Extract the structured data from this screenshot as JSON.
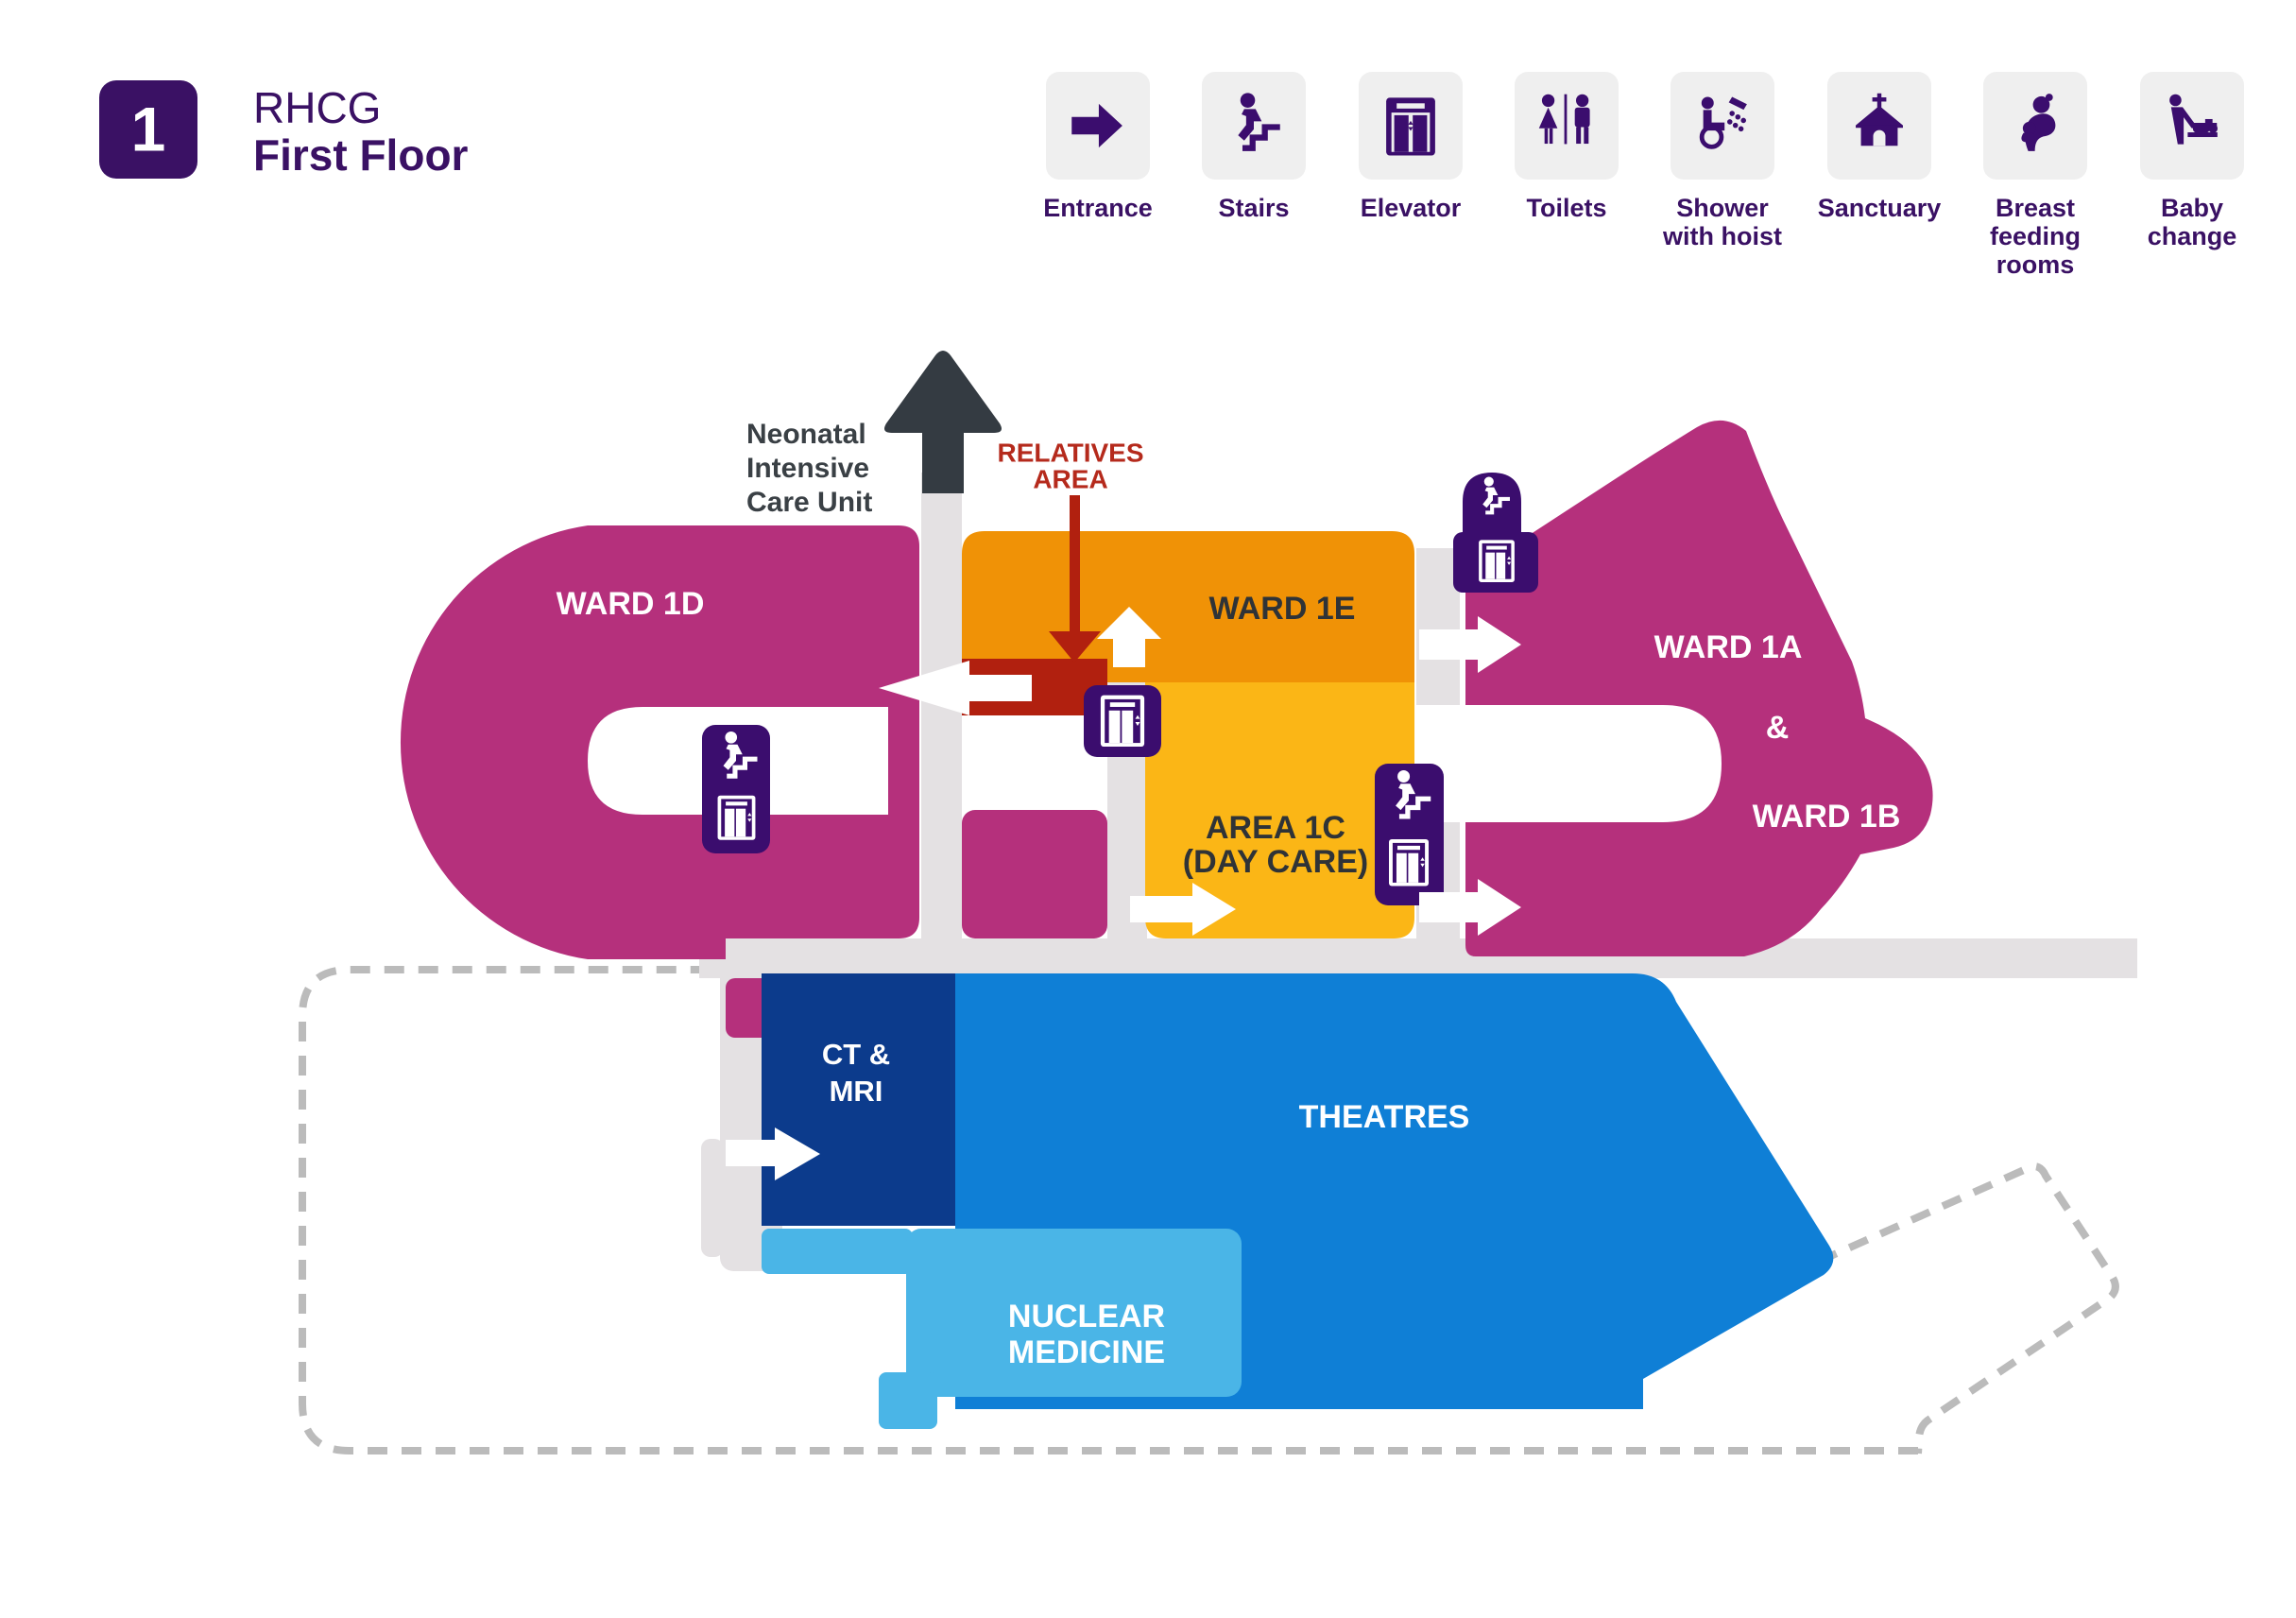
{
  "header": {
    "floor_number": "1",
    "site_code": "RHCG",
    "floor_name": "First Floor"
  },
  "legend": [
    {
      "icon": "entrance-icon",
      "lines": [
        "Entrance"
      ]
    },
    {
      "icon": "stairs-icon",
      "lines": [
        "Stairs"
      ]
    },
    {
      "icon": "elevator-icon",
      "lines": [
        "Elevator"
      ]
    },
    {
      "icon": "toilets-icon",
      "lines": [
        "Toilets"
      ]
    },
    {
      "icon": "shower-hoist-icon",
      "lines": [
        "Shower",
        "with hoist"
      ]
    },
    {
      "icon": "sanctuary-icon",
      "lines": [
        "Sanctuary"
      ]
    },
    {
      "icon": "breastfeeding-icon",
      "lines": [
        "Breast",
        "feeding",
        "rooms"
      ]
    },
    {
      "icon": "baby-change-icon",
      "lines": [
        "Baby",
        "change"
      ]
    }
  ],
  "map": {
    "labels": {
      "ward_1d": "WARD 1D",
      "ward_1e": "WARD 1E",
      "area_1c": [
        "AREA 1C",
        "(DAY CARE)"
      ],
      "ward_1a": "WARD 1A",
      "ampersand": "&",
      "ward_1b": "WARD 1B",
      "ct_mri": [
        "CT &",
        "MRI"
      ],
      "theatres": "THEATRES",
      "nuclear": [
        "NUCLEAR",
        "MEDICINE"
      ],
      "relatives": [
        "RELATIVES",
        "AREA"
      ],
      "nicu": [
        "Neonatal",
        "Intensive",
        "Care Unit"
      ]
    }
  },
  "colors": {
    "purple": "#3B0D6E",
    "header_purple": "#3A1164",
    "magenta": "#B5307C",
    "orange": "#F09206",
    "amber": "#FBB616",
    "dark_red": "#B1200F",
    "relatives_text": "#B52A1C",
    "navy": "#0C3B8C",
    "blue": "#0F7FD6",
    "light_blue": "#4AB5E7",
    "corridor_gray": "#E4E1E3",
    "tile_gray": "#EFEFEF",
    "charcoal": "#343B42",
    "dashed_gray": "#BBBBBB",
    "label_dark": "#2F3337",
    "white": "#FFFFFF"
  }
}
